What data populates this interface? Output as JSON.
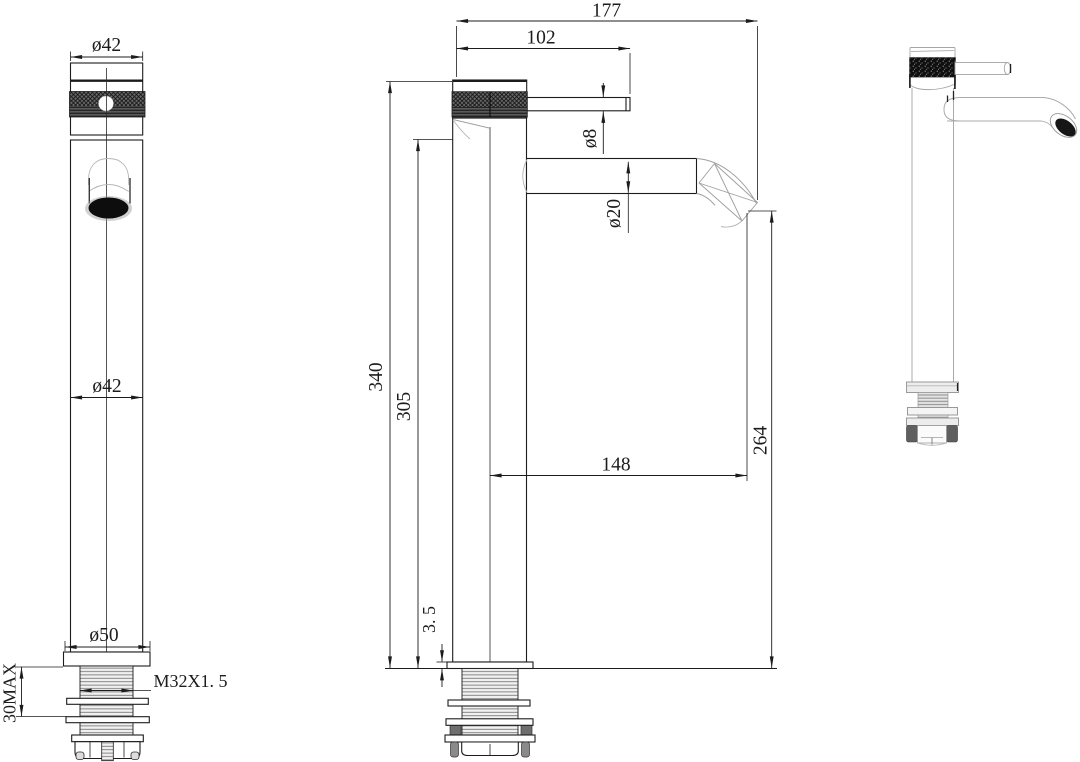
{
  "drawing": {
    "type": "faucet-installation-dimension-drawing",
    "background": "#ffffff",
    "line_color": "#1c1c1c",
    "dims": {
      "handle_diameter": "ø42",
      "body_diameter": "ø42",
      "base_diameter": "ø50",
      "thread_spec": "M32X1. 5",
      "max_mount_thickness": "30MAX",
      "overall_reach": "177",
      "lever_length": "102",
      "lever_rod_diameter": "ø8",
      "spout_diameter": "ø20",
      "overall_height": "340",
      "body_height": "305",
      "spout_reach_from_center": "148",
      "outlet_height_above_deck": "264",
      "base_plate_thickness": "3. 5"
    }
  }
}
